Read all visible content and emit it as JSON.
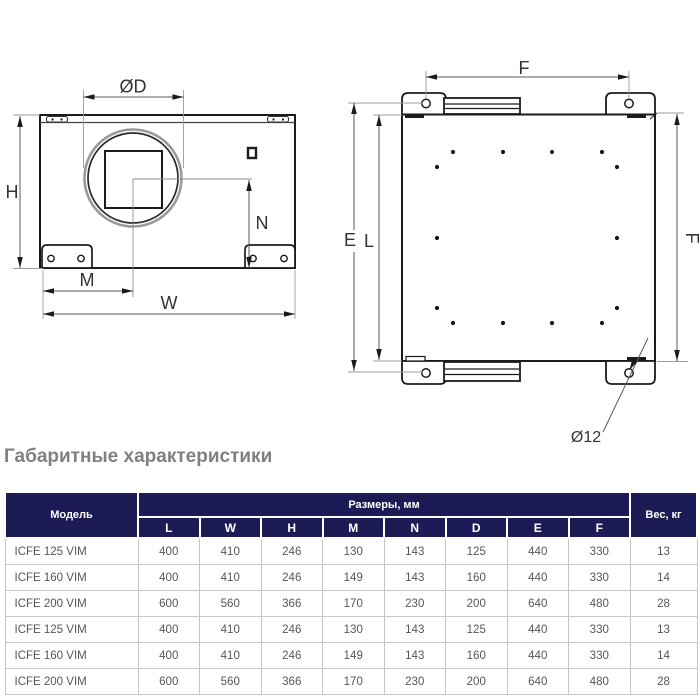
{
  "section_title": "Габаритные характеристики",
  "drawings": {
    "front_view": {
      "labels": {
        "d": "ØD",
        "h": "H",
        "n": "N",
        "m": "M",
        "w": "W"
      }
    },
    "side_view": {
      "labels": {
        "f_top": "F",
        "e": "E",
        "l": "L",
        "f_right": "F",
        "hole": "Ø12"
      }
    }
  },
  "table": {
    "model_header": "Модель",
    "dims_header": "Размеры, мм",
    "weight_header": "Вес, кг",
    "dim_columns": [
      "L",
      "W",
      "H",
      "M",
      "N",
      "D",
      "E",
      "F"
    ],
    "rows": [
      {
        "model": "ICFE 125 VIM",
        "values": [
          "400",
          "410",
          "246",
          "130",
          "143",
          "125",
          "440",
          "330"
        ],
        "weight": "13"
      },
      {
        "model": "ICFE 160 VIM",
        "values": [
          "400",
          "410",
          "246",
          "149",
          "143",
          "160",
          "440",
          "330"
        ],
        "weight": "14"
      },
      {
        "model": "ICFE 200 VIM",
        "values": [
          "600",
          "560",
          "366",
          "170",
          "230",
          "200",
          "640",
          "480"
        ],
        "weight": "28"
      },
      {
        "model": "ICFE 125 VIM",
        "values": [
          "400",
          "410",
          "246",
          "130",
          "143",
          "125",
          "440",
          "330"
        ],
        "weight": "13"
      },
      {
        "model": "ICFE 160 VIM",
        "values": [
          "400",
          "410",
          "246",
          "149",
          "143",
          "160",
          "440",
          "330"
        ],
        "weight": "14"
      },
      {
        "model": "ICFE 200 VIM",
        "values": [
          "600",
          "560",
          "366",
          "170",
          "230",
          "200",
          "640",
          "480"
        ],
        "weight": "28"
      }
    ]
  },
  "colors": {
    "table_header_bg": "#1d1b56",
    "table_body_text": "#55565c",
    "heading_text": "#7e8084",
    "drawing_line": "#1b1b1b"
  }
}
